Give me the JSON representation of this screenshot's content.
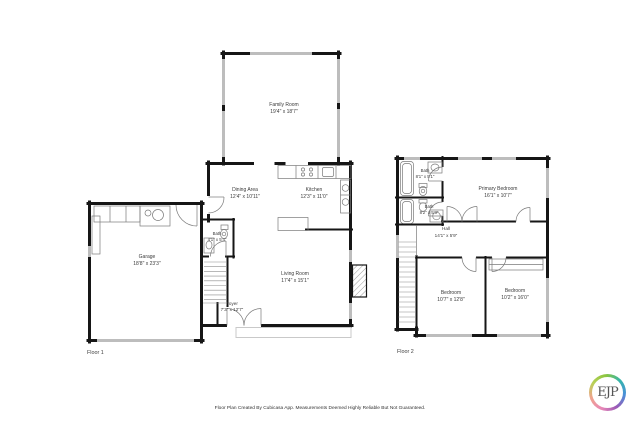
{
  "document": {
    "background": "#ffffff",
    "footer_disclaimer": "Floor Plan Created By Cubicasa App. Measurements Deemed Highly Reliable But Not Guaranteed.",
    "logo": {
      "text": "EJP",
      "ring_colors": [
        "#e887b7",
        "#8bc53f",
        "#35b5ac",
        "#4a90d9",
        "#9b59b6"
      ]
    }
  },
  "style": {
    "wall_color": "#161616",
    "window_color": "#bdbdbd",
    "fixture_color": "#7a7a7a"
  },
  "floor1": {
    "label": "Floor 1",
    "rooms": {
      "family_room": {
        "name": "Family Room",
        "dims": "19'4\" x 18'7\""
      },
      "dining_area": {
        "name": "Dining Area",
        "dims": "12'4\" x 10'11\""
      },
      "kitchen": {
        "name": "Kitchen",
        "dims": "12'3\" x 11'0\""
      },
      "garage": {
        "name": "Garage",
        "dims": "18'8\" x 23'3\""
      },
      "bath": {
        "name": "Bath",
        "dims": "4'1\" x 5'4\""
      },
      "living_room": {
        "name": "Living Room",
        "dims": "17'4\" x 15'1\""
      },
      "foyer": {
        "name": "Foyer",
        "dims": "7'3\" x 12'7\""
      }
    }
  },
  "floor2": {
    "label": "Floor 2",
    "rooms": {
      "bath_upper": {
        "name": "Bath",
        "dims": "8'1\" x 5'1\""
      },
      "primary_bedroom": {
        "name": "Primary Bedroom",
        "dims": "16'1\" x 10'7\""
      },
      "bath_lower": {
        "name": "Bath",
        "dims": "8'2\" x 5'3\""
      },
      "hall": {
        "name": "Hall",
        "dims": "14'1\" x 5'9\""
      },
      "bedroom_left": {
        "name": "Bedroom",
        "dims": "10'7\" x 12'8\""
      },
      "bedroom_right": {
        "name": "Bedroom",
        "dims": "10'2\" x 16'0\""
      }
    }
  }
}
